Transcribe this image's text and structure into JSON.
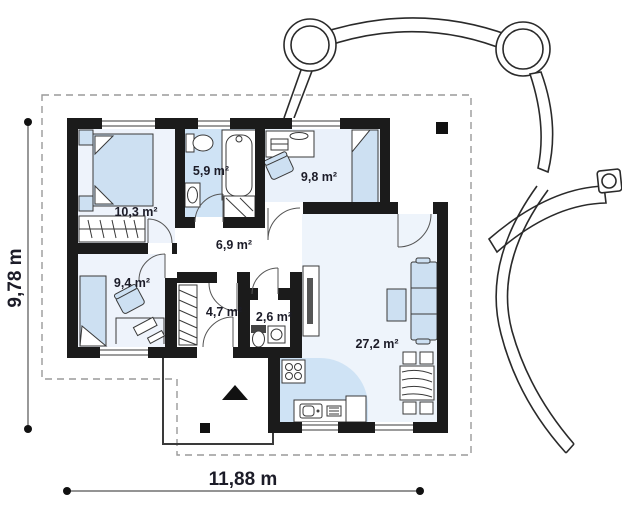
{
  "plan": {
    "type": "floor-plan",
    "rooms": [
      {
        "name": "bedroom-1",
        "area": "10,3 m²"
      },
      {
        "name": "bathroom",
        "area": "5,9 m²"
      },
      {
        "name": "bedroom-2",
        "area": "9,8 m²"
      },
      {
        "name": "hall",
        "area": "6,9 m²"
      },
      {
        "name": "bedroom-3",
        "area": "9,4 m²"
      },
      {
        "name": "vestibule",
        "area": "4,7 m²"
      },
      {
        "name": "wc",
        "area": "2,6 m²"
      },
      {
        "name": "living-room-kitchen",
        "area": "27,2 m²"
      }
    ],
    "dimensions": {
      "width_label": "11,88 m",
      "height_label": "9,78 m"
    },
    "colors": {
      "wall": "#1b1b1b",
      "furniture_fill": "#cde0f2",
      "wet_room_floor": "#cfe3f5",
      "room_floor_tint": "#e9eff8",
      "label_text": "#1c1c28",
      "dashed_outline": "#9a9a9a"
    }
  }
}
